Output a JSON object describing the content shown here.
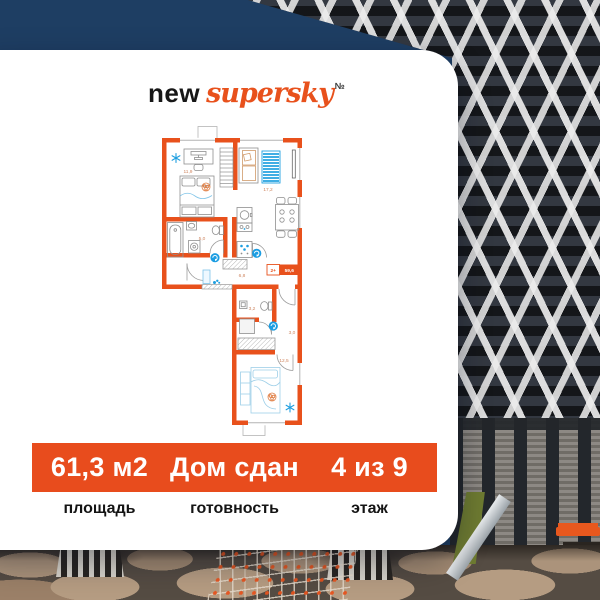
{
  "logo": {
    "prefix": "new",
    "name": "supersky",
    "mark": "№"
  },
  "floor_plan": {
    "badge": {
      "rooms": "2+",
      "area": "59,6"
    },
    "rooms": [
      {
        "name": "bedroom-1",
        "label": "11,9"
      },
      {
        "name": "kitchen-living",
        "label": "17,2"
      },
      {
        "name": "bathroom",
        "label": "5,0"
      },
      {
        "name": "hallway",
        "label": "6,8"
      },
      {
        "name": "wc",
        "label": "3,2"
      },
      {
        "name": "corridor",
        "label": "3,0"
      },
      {
        "name": "bedroom-2",
        "label": "12,5"
      }
    ],
    "icons": [
      "snowflake-icon",
      "door-marker-icon",
      "plant-icon"
    ]
  },
  "info_bar": {
    "items": [
      {
        "value": "61,3 м2",
        "label": "площадь"
      },
      {
        "value": "Дом сдан",
        "label": "готовность"
      },
      {
        "value": "4 из 9",
        "label": "этаж"
      }
    ]
  },
  "colors": {
    "accent_orange": "#e84c1d",
    "wall_orange": "#e8511c",
    "sky_navy": "#1e3e63",
    "plan_blue": "#1f9fe0",
    "room_label": "#cf8660"
  }
}
